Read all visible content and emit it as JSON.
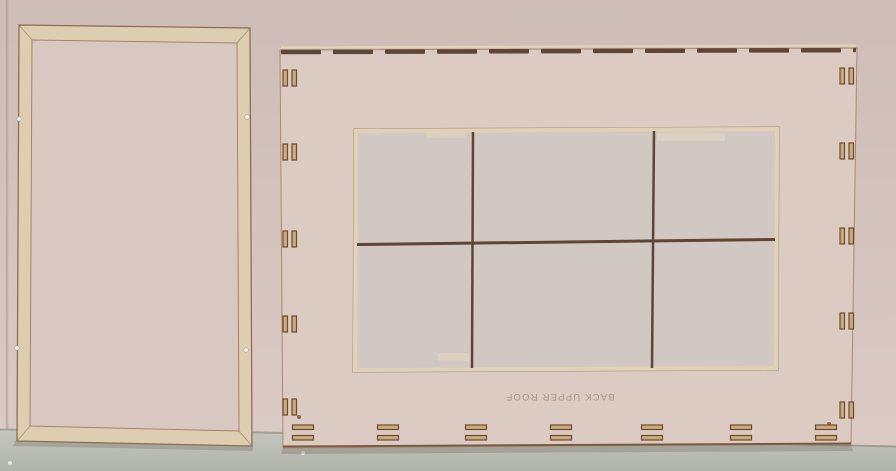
{
  "scene": {
    "kind": "photo of laser-cut MDF kit panels leaning against a wall"
  },
  "colors": {
    "wall_top": "#cebdb7",
    "wall_bottom": "#dccbc5",
    "floor_top": "#c6c8c0",
    "floor_bottom": "#b0b3aa",
    "frame_cream": "#ddceb2",
    "face_pink": "#d9c8c1",
    "face_pink_right": "#dbcbc3",
    "window_interior": "#d1c8c4",
    "grid_brown": "#5f4533",
    "cut_cream": "#e6d8bf",
    "edge_brown": "#8f6d52"
  },
  "left_panel": {
    "pins": [
      [
        19,
        119
      ],
      [
        247,
        117
      ],
      [
        17,
        348
      ],
      [
        246,
        350
      ]
    ]
  },
  "right_panel": {
    "label": "BACK UPPER ROOF",
    "label_color": "#97816e",
    "slot_fill": "#c9ab7e",
    "slot_stroke": "#6e4a30",
    "left_slot_x": 283,
    "right_slot_x": 840,
    "left_slot_pairs_y": [
      78,
      152,
      239,
      324,
      407
    ],
    "right_slot_pairs_y": [
      76,
      151,
      236,
      321,
      410
    ],
    "bottom_slot_pairs_x": [
      303,
      388,
      476,
      561,
      652,
      741,
      826
    ],
    "bottom_slot_y": [
      425,
      435.5
    ],
    "top_edge": {
      "x1": 281,
      "x2": 856,
      "y1": 52,
      "y2": 50,
      "segment": 40,
      "gap": 12,
      "thickness": 4.5
    },
    "corner_dots": [
      [
        299,
        417
      ],
      [
        829,
        424
      ]
    ],
    "window": {
      "streaks": [
        [
          427,
          132,
          38,
          6
        ],
        [
          657,
          133,
          68,
          8
        ],
        [
          438,
          353,
          32,
          8
        ]
      ]
    }
  },
  "floor": {
    "specks": [
      [
        303,
        453
      ],
      [
        10,
        463
      ]
    ]
  }
}
